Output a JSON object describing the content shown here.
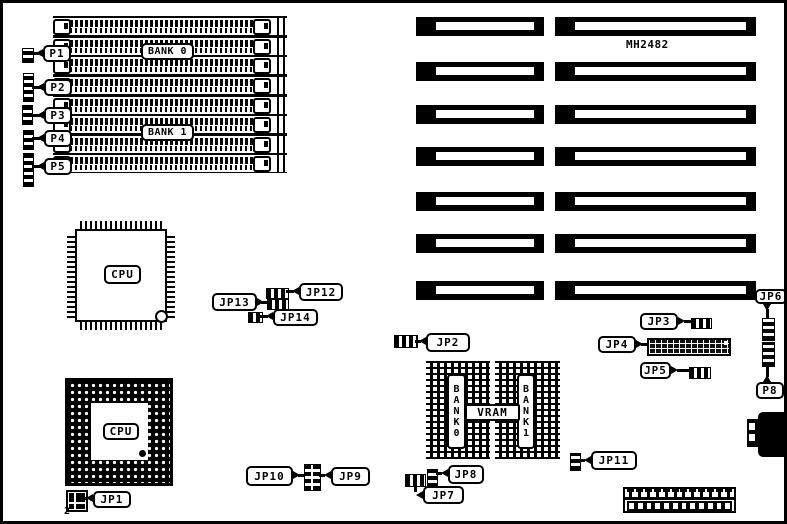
{
  "diagram": {
    "model": "MH2482",
    "memory": {
      "bank0": "BANK 0",
      "bank1": "BANK 1"
    },
    "chips": {
      "qfp_cpu": "CPU",
      "pga_cpu": "CPU"
    },
    "vram": {
      "title": "VRAM",
      "bank0": "BANK0",
      "bank1": "BANK1"
    },
    "connectors": {
      "p1": "P1",
      "p2": "P2",
      "p3": "P3",
      "p4": "P4",
      "p5": "P5",
      "p8": "P8"
    },
    "jumpers": {
      "jp1": "JP1",
      "jp2": "JP2",
      "jp3": "JP3",
      "jp4": "JP4",
      "jp5": "JP5",
      "jp6": "JP6",
      "jp7": "JP7",
      "jp8": "JP8",
      "jp9": "JP9",
      "jp10": "JP10",
      "jp11": "JP11",
      "jp12": "JP12",
      "jp13": "JP13",
      "jp14": "JP14"
    },
    "annotations": {
      "jp1_pin2": "2"
    }
  }
}
